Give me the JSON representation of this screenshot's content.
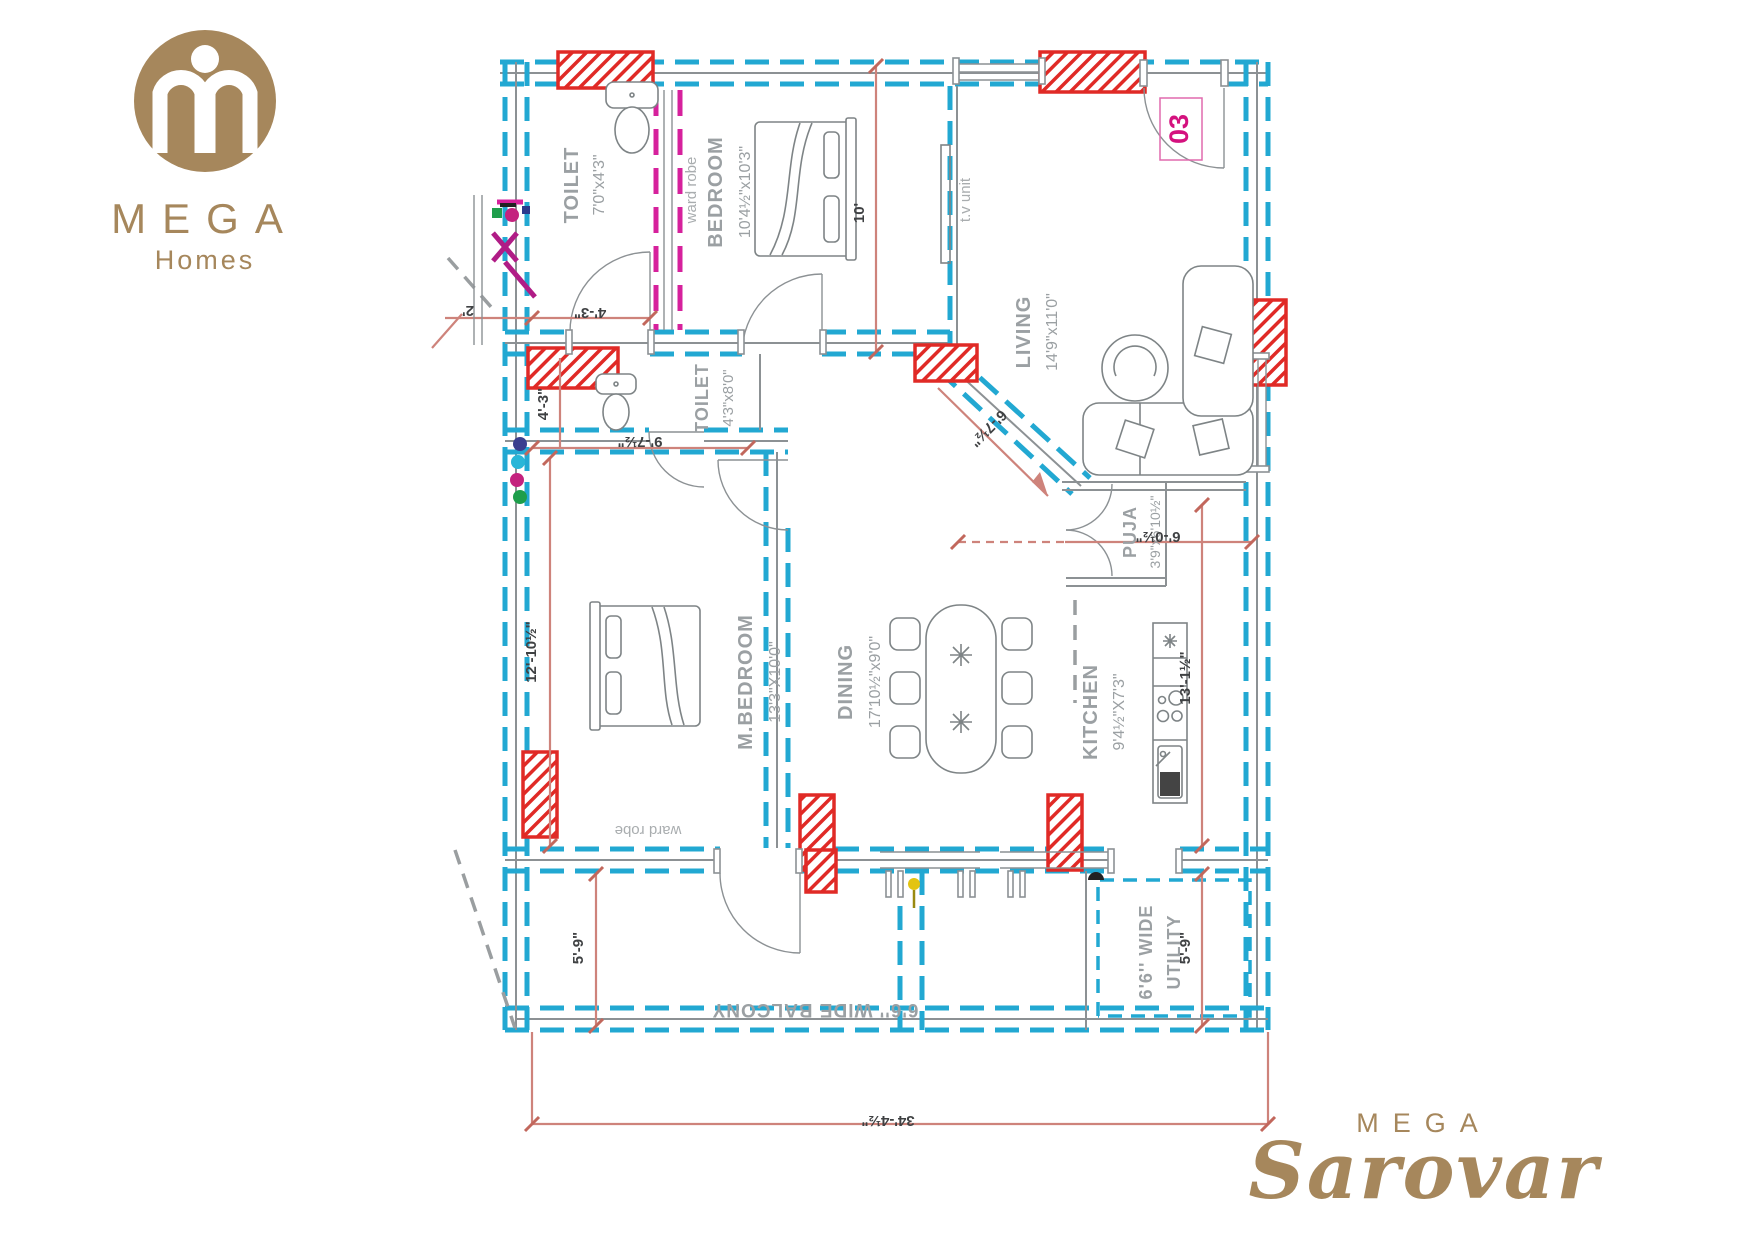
{
  "branding": {
    "top_logo": {
      "title": "MEGA",
      "subtitle": "Homes"
    },
    "bottom_logo": {
      "title": "MEGA",
      "subtitle": "Sarovar"
    },
    "brand_color": "#A6875C"
  },
  "unit": {
    "number": "03"
  },
  "rooms": {
    "toilet1": {
      "name": "TOILET",
      "size": "7'0\"x4'3\""
    },
    "bedroom": {
      "name": "BEDROOM",
      "size": "10'4½\"x10'3\""
    },
    "living": {
      "name": "LIVING",
      "size": "14'9\"x11'0\""
    },
    "toilet2": {
      "name": "TOILET",
      "size": "4'3\"x8'0\""
    },
    "mbedroom": {
      "name": "M.BEDROOM",
      "size": "13'3\"X10'0\""
    },
    "dining": {
      "name": "DINING",
      "size": "17'10½\"x9'0\""
    },
    "kitchen": {
      "name": "KITCHEN",
      "size": "9'4½\"X7'3\""
    },
    "puja": {
      "name": "PUJA",
      "size": "3'9\"x6'10½\""
    },
    "balcony": {
      "name": "6'6'' WIDE BALCONY"
    },
    "utility": {
      "name_line1": "6'6'' WIDE",
      "name_line2": "UTILITY"
    }
  },
  "annotations": {
    "wardrobe_bedroom": "ward robe",
    "wardrobe_mbedroom": "ward robe",
    "tv_unit": "t.v unit"
  },
  "dimensions": {
    "entry_2ft": "2'",
    "toilet1_w": "4'-3\"",
    "bedroom_h": "10'",
    "toilet2_h": "4'-3\"",
    "toilet2_w": "9'-7½\"",
    "living_diag": "6'-7½\"",
    "puja_w": "6'-0½\"",
    "mbedroom_h": "12'-10½\"",
    "kitchen_h": "13'-1½\"",
    "balcony_h": "5'-9\"",
    "utility_h": "5'-9\"",
    "total_width": "34'-4½\""
  },
  "colors": {
    "wall_cyan": "#22A8D2",
    "column_red": "#E02A26",
    "dimension_salmon": "#CE837B",
    "label_gray": "#9BA0A3",
    "accent_magenta": "#D6219C",
    "unit_magenta": "#D4117E"
  }
}
